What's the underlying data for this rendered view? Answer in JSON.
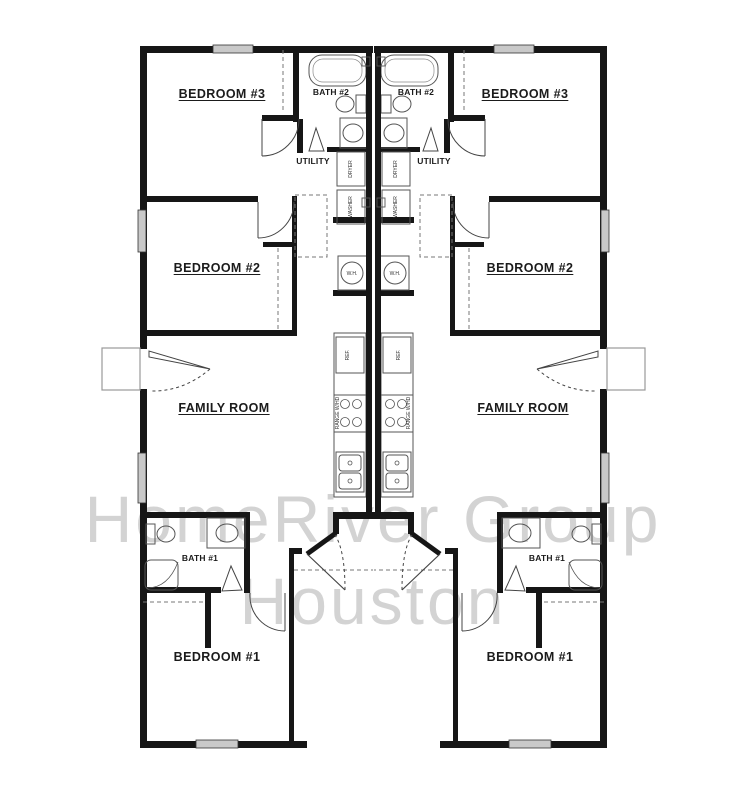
{
  "watermark": {
    "line1": "HomeRiver Group",
    "line2": "Houston"
  },
  "floorplan": {
    "type": "duplex-mirrored",
    "left_unit": {
      "bedroom3": "BEDROOM #3",
      "bath2": "BATH #2",
      "utility": "UTILITY",
      "bedroom2": "BEDROOM #2",
      "family_room": "FAMILY ROOM",
      "bath1": "BATH #1",
      "bedroom1": "BEDROOM #1",
      "dryer": "DRYER",
      "washer": "WASHER",
      "water_heater": "W.H.",
      "refrigerator": "REF.",
      "range": "RANGE W/HD"
    },
    "right_unit": {
      "bedroom3": "BEDROOM #3",
      "bath2": "BATH #2",
      "utility": "UTILITY",
      "bedroom2": "BEDROOM #2",
      "family_room": "FAMILY ROOM",
      "bath1": "BATH #1",
      "bedroom1": "BEDROOM #1",
      "dryer": "DRYER",
      "washer": "WASHER",
      "water_heater": "W.H.",
      "refrigerator": "REF.",
      "range": "RANGE W/HD"
    },
    "colors": {
      "wall": "#161616",
      "fixture_line": "#555555",
      "window_fill": "#c9c9c9",
      "watermark": "#d3d3d3",
      "background": "#ffffff"
    }
  }
}
